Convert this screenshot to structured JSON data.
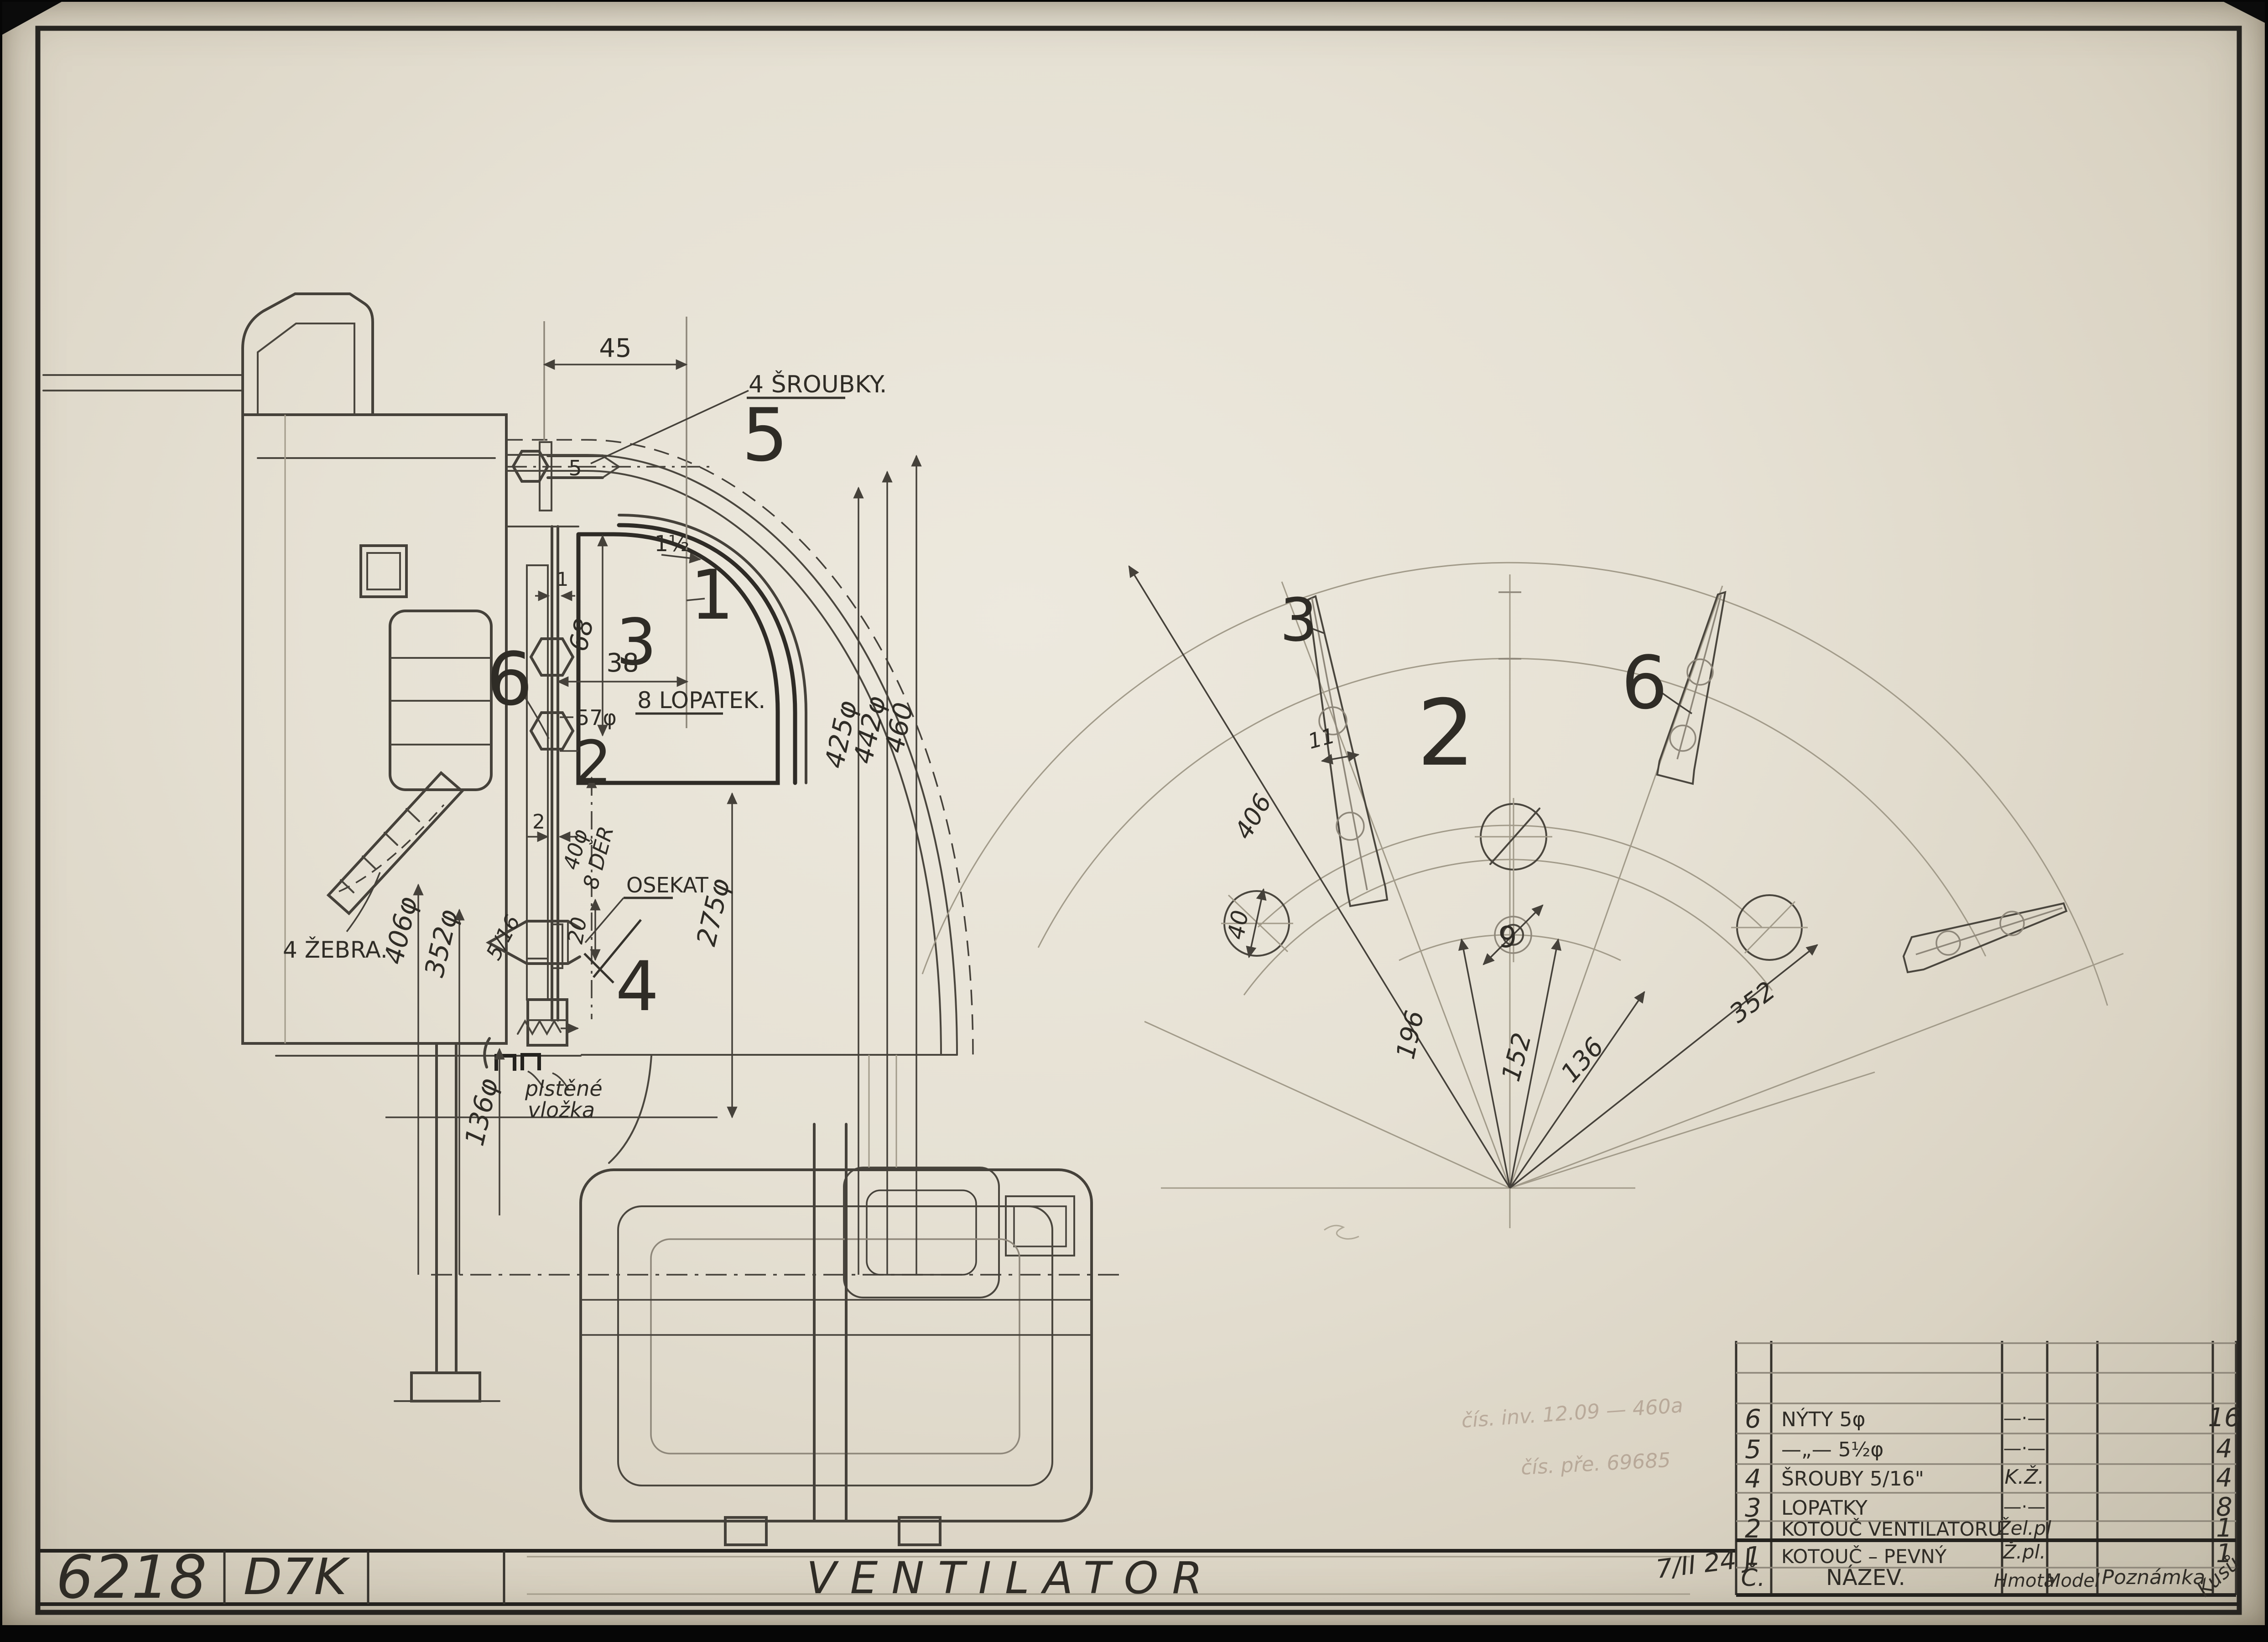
{
  "title_block": {
    "number": "6218",
    "code": "D7K",
    "title": "VENTILATOR",
    "date_note": "7/II 24 J"
  },
  "stamps": {
    "line1": "čís. inv. 12.09 — 460a",
    "line2": "čís. pře. 69685"
  },
  "parts_table": {
    "headers": {
      "no": "Č.",
      "name": "NÁZEV.",
      "material": "Hmota",
      "model": "Model",
      "note": "Poznámka",
      "qty": "Kusů"
    },
    "rows": [
      {
        "no": "6",
        "name": "NÝTY 5φ",
        "material": "—·—",
        "qty": "16"
      },
      {
        "no": "5",
        "name": "—„— 5½φ",
        "material": "—·—",
        "qty": "4"
      },
      {
        "no": "4",
        "name": "ŠROUBY 5/16\"",
        "material": "K.Ž.",
        "qty": "4"
      },
      {
        "no": "3",
        "name": "LOPATKY",
        "material": "—·—",
        "qty": "8"
      },
      {
        "no": "2",
        "name": "KOTOUČ VENTILATORU",
        "material": "Žel.pl",
        "qty": "1"
      },
      {
        "no": "1",
        "name": "KOTOUČ – PEVNÝ",
        "material": "Ž.pl.",
        "qty": "1"
      }
    ]
  },
  "left_view": {
    "dim_45": "45",
    "screws_note": "4 ŠROUBKY.",
    "balloon_5": "5",
    "bolt_dia": "5",
    "dim_1half": "1½",
    "balloon_1": "1",
    "balloon_3": "3",
    "dim_68": "68",
    "dim_38": "38",
    "blades_note": "8 LOPATEK.",
    "dim_57": "57φ",
    "balloon_6": "6",
    "balloon_2": "2",
    "plate_thk": "1",
    "disc_thk": "2",
    "holes_note_1": "40φ",
    "holes_note_2": "8 DĚR",
    "osekat": "OSEKAT",
    "dim_20": "20",
    "balloon_4": "4",
    "dim_275": "275φ",
    "dim_425": "425φ",
    "dim_442": "442φ",
    "dim_460": "460",
    "ribs_note": "4 ŽEBRA.",
    "dim_406": "406φ",
    "dim_352": "352φ",
    "dim_136": "136φ",
    "bolt_size": "5/16",
    "felt_note_1": "plstěné",
    "felt_note_2": "vložka"
  },
  "right_view": {
    "balloon_3": "3",
    "dim_11": "11",
    "dim_406": "406",
    "balloon_6": "6",
    "disc_label": "2",
    "hole_label": "9",
    "dim_196": "196",
    "dim_152": "152",
    "dim_136": "136",
    "dim_352": "352",
    "dim_40": "40"
  }
}
